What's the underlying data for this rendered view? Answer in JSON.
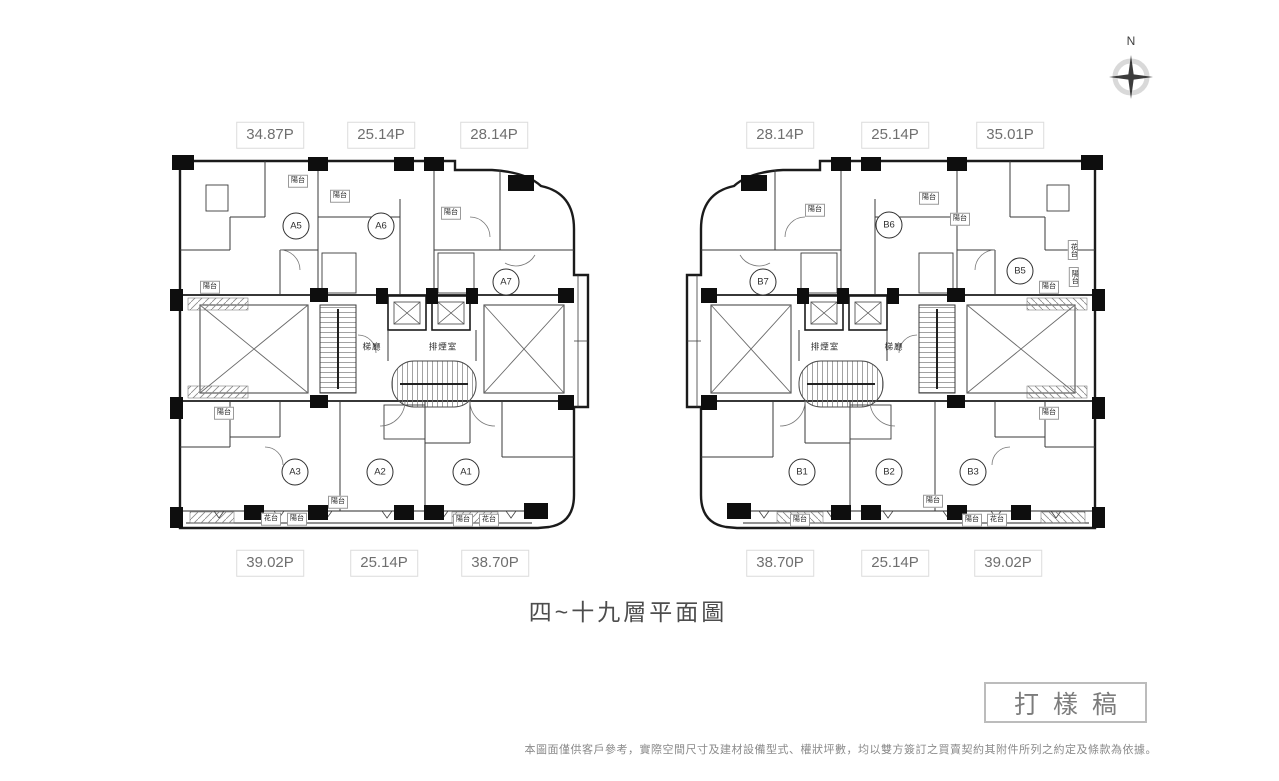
{
  "compass": {
    "north_label": "N"
  },
  "floor_title": "四~十九層平面圖",
  "stamp_label": "打樣稿",
  "disclaimer": "本圖面僅供客戶參考，實際空間尺寸及建材設備型式、權狀坪數，均以雙方簽訂之買賣契約其附件所列之約定及條款為依據。",
  "room_labels": {
    "balcony": "陽台",
    "flower_bed": "花台",
    "stair_hall": "梯廳",
    "smoke_exhaust": "排煙室"
  },
  "left_plan": {
    "top_areas": [
      "34.87P",
      "25.14P",
      "28.14P"
    ],
    "bottom_areas": [
      "39.02P",
      "25.14P",
      "38.70P"
    ],
    "units": [
      "A5",
      "A6",
      "A7",
      "A3",
      "A2",
      "A1"
    ]
  },
  "right_plan": {
    "top_areas": [
      "28.14P",
      "25.14P",
      "35.01P"
    ],
    "bottom_areas": [
      "38.70P",
      "25.14P",
      "39.02P"
    ],
    "units": [
      "B7",
      "B6",
      "B5",
      "B1",
      "B2",
      "B3"
    ]
  }
}
